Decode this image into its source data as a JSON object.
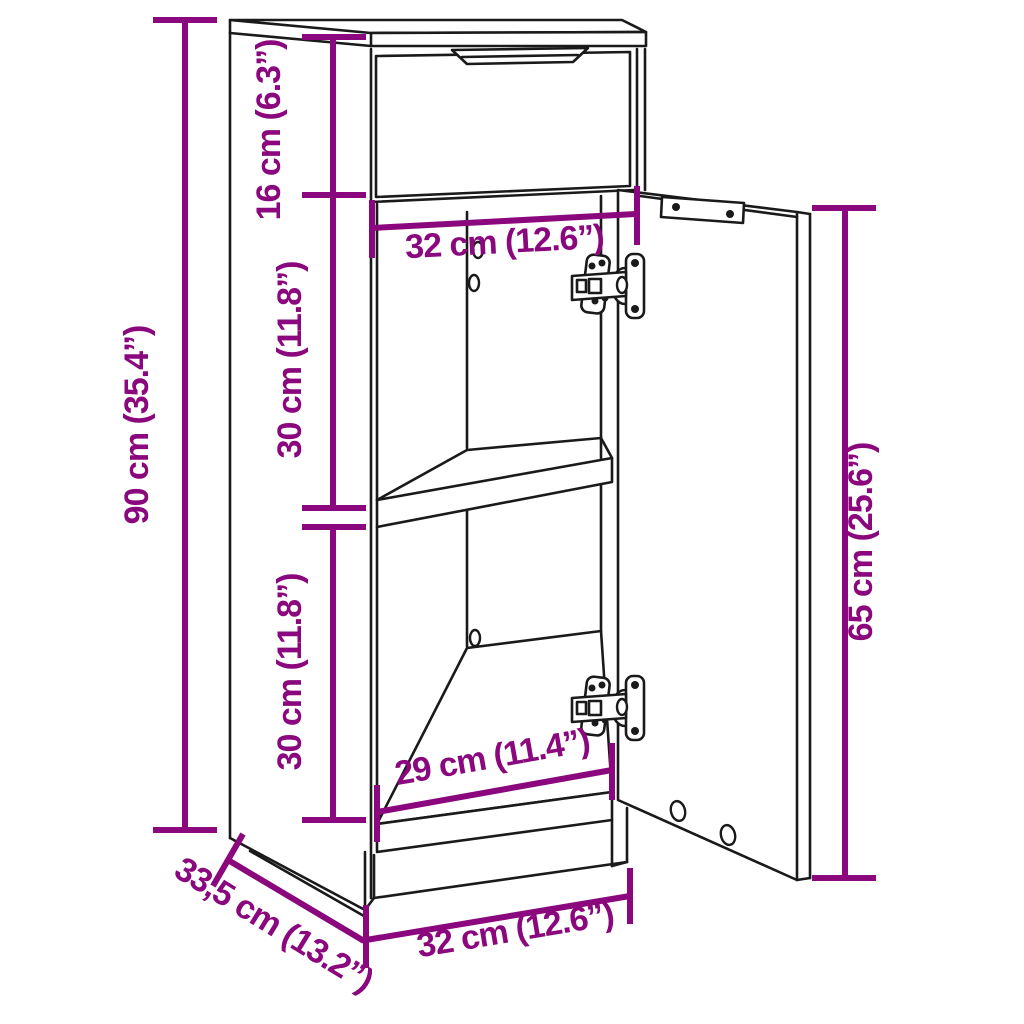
{
  "diagram": {
    "type": "furniture-dimension-diagram",
    "subject": "narrow cabinet with top drawer, middle shelf and open right-hand door",
    "units": [
      "cm",
      "inch"
    ],
    "dimensions": {
      "height_total": "90 cm (35.4”)",
      "drawer_section_height": "16 cm (6.3”)",
      "inner_width_top": "32 cm (12.6”)",
      "upper_compartment_height": "30 cm (11.8”)",
      "lower_compartment_height": "30 cm (11.8”)",
      "inner_width_bottom": "29 cm (11.4”)",
      "door_height": "65 cm (25.6”)",
      "depth": "33,5 cm (13.2”)",
      "width_total": "32 cm (12.6”)"
    },
    "colors": {
      "dimension": "#8A077D",
      "line": "#1a1a1a",
      "background": "#ffffff"
    }
  }
}
